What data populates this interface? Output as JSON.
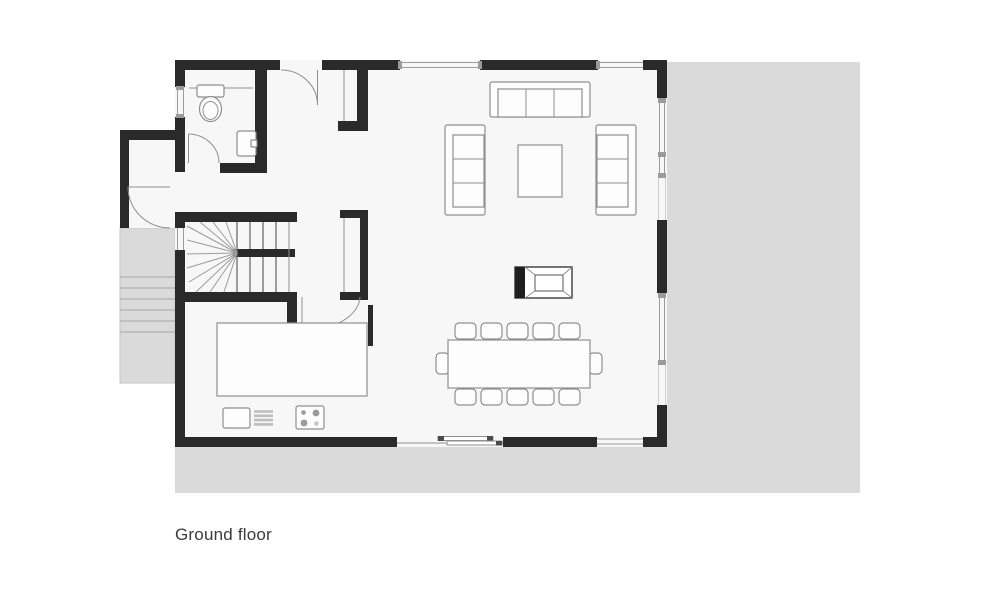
{
  "title": "Ground floor",
  "colors": {
    "wall": "#2a2a2a",
    "line": "#8f8f8f",
    "floor": "#f7f7f8",
    "terrace": "#dadada",
    "terrace_line": "#a6a6a6",
    "text": "#3b3b3b"
  },
  "floorplan": {
    "label": "Ground floor",
    "elements": [
      "terrace",
      "exterior-stairs",
      "entry-porch",
      "entry-door",
      "bathroom",
      "toilet",
      "bathroom-sink",
      "staircase",
      "wardrobe-upper",
      "wardrobe-lower",
      "kitchen",
      "kitchen-counter",
      "kitchen-sink",
      "stove",
      "living-room",
      "sofa-top",
      "sofa-left",
      "sofa-right",
      "coffee-table",
      "fireplace",
      "dining-table",
      "dining-chairs",
      "sliding-door",
      "windows"
    ]
  }
}
